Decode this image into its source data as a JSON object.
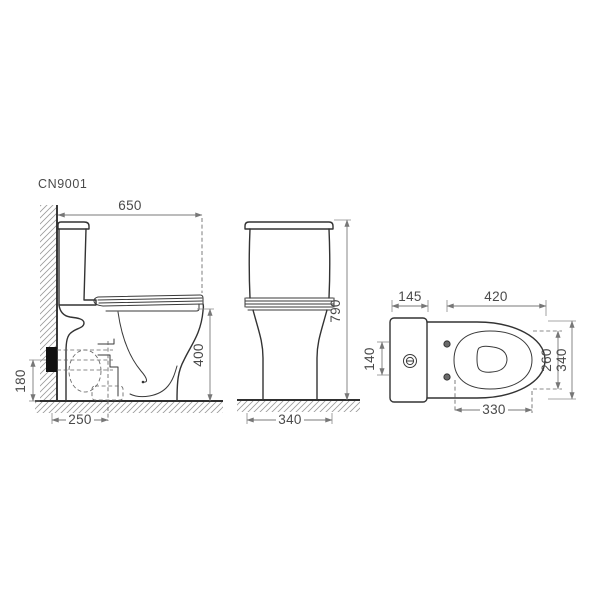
{
  "drawing": {
    "model": "CN9001",
    "colors": {
      "background": "#ffffff",
      "outline": "#333333",
      "dimension_line": "#7a7a7a",
      "text": "#4a4a4a",
      "outlet_fill": "#111111",
      "hatch": "#9a9a9a"
    },
    "side": {
      "width": "650",
      "bowl_height": "400",
      "outlet_height": "180",
      "outlet_offset": "250"
    },
    "front": {
      "total_height": "790",
      "base_width": "340"
    },
    "top": {
      "tank_depth": "145",
      "seat_length": "420",
      "flush_span": "140",
      "inner_width": "260",
      "overall_width": "340",
      "bowl_length": "330"
    }
  }
}
